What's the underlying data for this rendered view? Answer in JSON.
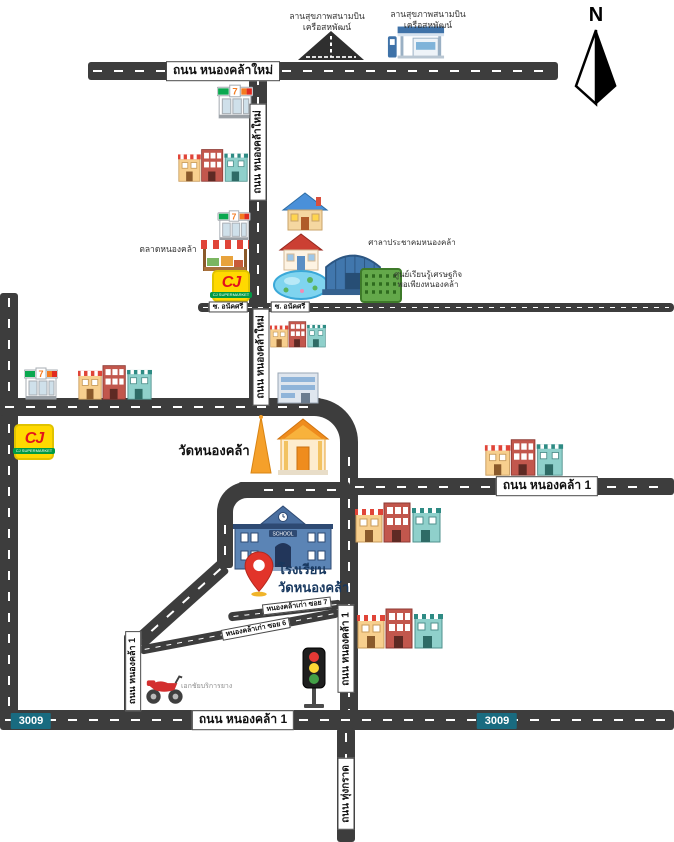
{
  "compass": {
    "north": "N"
  },
  "roads": {
    "nongkhla_mai": "ถนน หนองคล้าใหม่",
    "nongkhla_1": "ถนน หนองคล้า 1",
    "soi_anaksri": "ซ. อนัคศรี",
    "soi_7": "หนองคล้าเก่า ซอย 7",
    "soi_6": "หนองคล้าเก่า ซอย 6",
    "thung_krat": "ถนน ทุ่งกราด",
    "route_badge": "3009"
  },
  "places": {
    "airstrip_line1": "ลานสุขภาพสนามบิน",
    "airstrip_line2": "เครือสหพัฒน์",
    "gas_line1": "ลานสุขภาพสนามบิน",
    "gas_line2": "เครือสหพัฒน์",
    "market": "ตลาดหนองคล้า",
    "community_hall": "ศาลาประชาคมหนองคล้า",
    "learning_center_line1": "ศูนย์เรียนรู้เศรษฐกิจ",
    "learning_center_line2": "พอเพียงหนองคล้า",
    "temple": "วัดหนองคล้า",
    "school_line1": "โรงเรียน",
    "school_line2": "วัดหนองคล้า",
    "school_sign": "SCHOOL",
    "tire_service": "เอกชัยบริการยาง",
    "seven_sign": "7",
    "cj_text": "CJ",
    "cj_sub": "CJ SUPERMARKET"
  },
  "colors": {
    "road": "#3d3d3d",
    "badge-teal": "#196b80",
    "cj-yellow": "#ffd900",
    "cj-red": "#e3131b",
    "cj-green": "#009a44",
    "pin-red": "#e2342a",
    "school-blue": "#5b84b5",
    "temple-orange": "#f5a02a",
    "hall-blue": "#4177ad"
  }
}
